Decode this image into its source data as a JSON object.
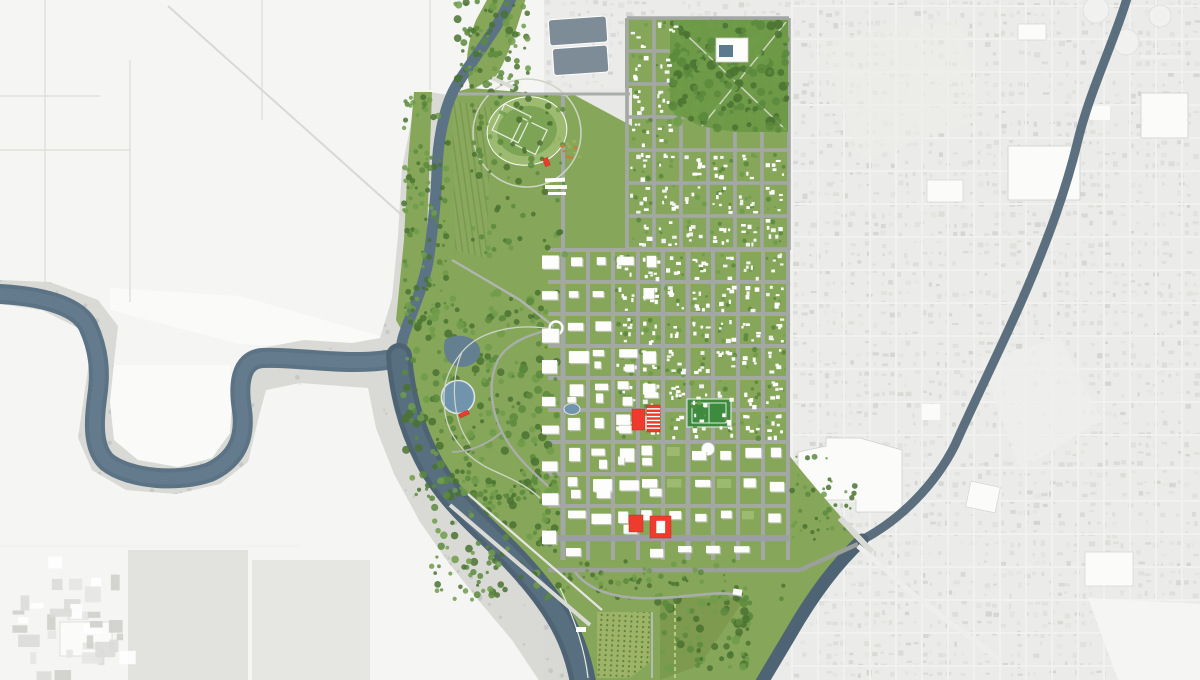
{
  "meta": {
    "title": "Riverfront downtown master plan — rendered aerial map",
    "description": "Aerial rendering: colored master-plan area (downtown grid, riverfront parks, south delta) over desaturated gray context city and farmland; meandering river on west, creek on east; red buildings mark development sites."
  },
  "palette": {
    "bg": "#ebebe9",
    "cityBase": "#e9e9e7",
    "cityStreet": "#f1f1ef",
    "speckDark": "#d2d2cf",
    "speckMid": "#dcdcd9",
    "speckLight": "#e3e3e0",
    "bigWhite": "#fbfbfa",
    "outlineGray": "#cfcfcc",
    "farm": "#f5f5f3",
    "farmWhite": "#fafaf9",
    "farmLine": "#e0e0dd",
    "wood": "#d6d6d3",
    "woodSpeck": "#c0c0bd",
    "riverDark": "#4e6474",
    "river": "#5b7385",
    "riverLight": "#6d8495",
    "lagoon": "#7d8c97",
    "planBase": "#86a65a",
    "parkDark": "#6e9a47",
    "tree1": "#4a7231",
    "tree2": "#5c8a3d",
    "tree3": "#6f9c4a",
    "lawnLight": "#9cba70",
    "pitch": "#3e8b3f",
    "street": "#a3a8a4",
    "streetMajor": "#9ba09c",
    "bldgWhite": "#fdfdfc",
    "bldgShadow": "#c9c9c6",
    "red": "#ee3b2d",
    "pond": "#7094ac",
    "pondDark": "#647f90",
    "path": "#cfd6c9",
    "parkRoad": "#a9aeab",
    "orchardBg": "#9db468",
    "orchardDot": "#5e8138",
    "rowBg": "#8aa95e",
    "rowLine": "#78994c",
    "meadow": "#7d9a4e",
    "wedge": "#e8e8e6",
    "bridge": "#dadad7",
    "gardenA": "#cbb94a",
    "gardenB": "#9ab05a",
    "gardenC": "#c27f3e"
  },
  "features": {
    "river_west": "meandering river with oxbow loop",
    "creek_east": "east creek joining river at south bridge",
    "plan_area": "colored master-plan district",
    "left_park": "riverfront park with circular pond",
    "top_park": "north neighborhood park with school",
    "sports_oval": "athletics oval with ball diamonds",
    "stadium": "football field",
    "delta": "south green delta with orchard and meadows",
    "context_city": "grayscale existing city",
    "farmland": "grayscale farmland west",
    "lagoons": "two treatment lagoons north"
  },
  "highlights": [
    {
      "name": "site-a",
      "x": 632,
      "y": 409,
      "w": 13,
      "h": 21,
      "style": "solid",
      "rot": 0
    },
    {
      "name": "site-b",
      "x": 647,
      "y": 405,
      "w": 13,
      "h": 27,
      "style": "striped",
      "rot": 0
    },
    {
      "name": "site-c",
      "x": 629,
      "y": 515,
      "w": 14,
      "h": 17,
      "style": "solid",
      "rot": 0
    },
    {
      "name": "site-d",
      "x": 650,
      "y": 516,
      "w": 21,
      "h": 22,
      "style": "ring",
      "rot": 0
    },
    {
      "name": "marker-north",
      "x": 544,
      "y": 158,
      "w": 5,
      "h": 8,
      "style": "solid",
      "rot": -20
    },
    {
      "name": "marker-park",
      "x": 459,
      "y": 412,
      "w": 10,
      "h": 4,
      "style": "solid",
      "rot": -25
    }
  ]
}
